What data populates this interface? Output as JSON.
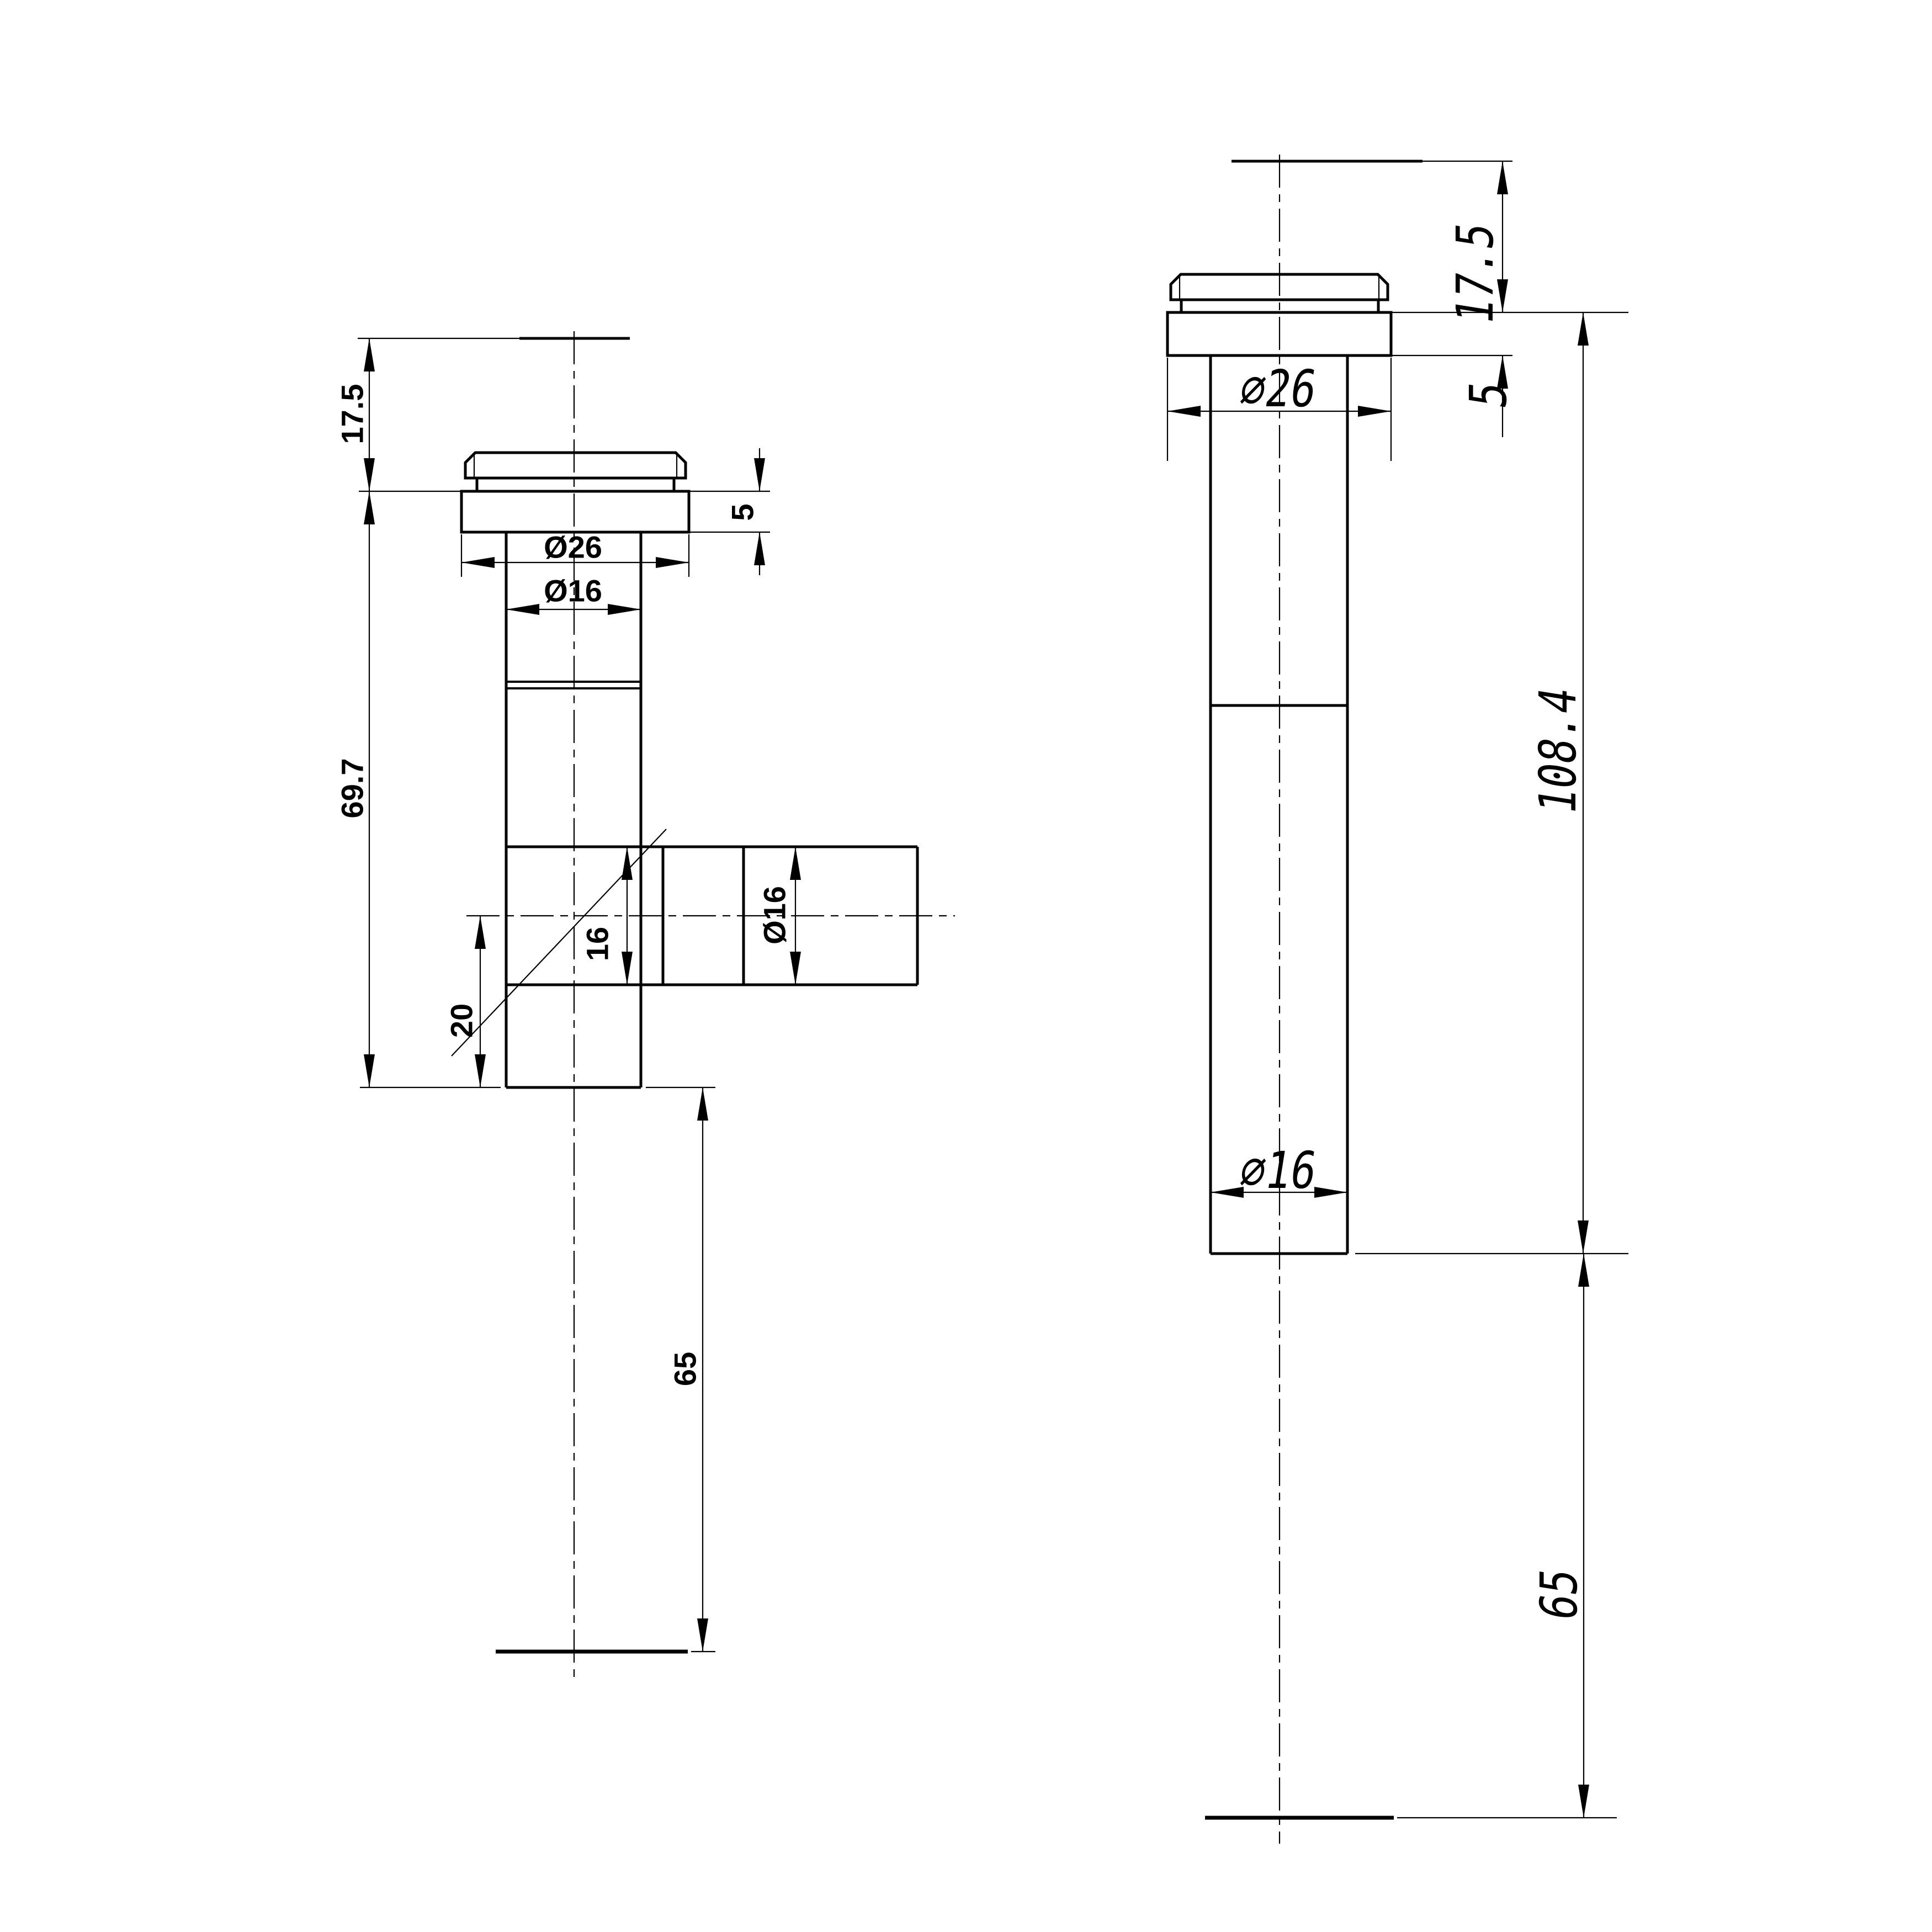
{
  "drawing": {
    "type": "engineering-2d-orthographic",
    "background_color": "#ffffff",
    "line_color": "#000000",
    "views": {
      "left": {
        "name": "side view with outlet arm",
        "dims": {
          "height_top": "17.5",
          "flange_thickness": "5",
          "flange_diameter": "Ø26",
          "tube_diameter": "Ø16",
          "body_length": "69.7",
          "arm_bore": "16",
          "arm_diameter": "Ø16",
          "offset_bottom": "20",
          "tail_length": "65"
        }
      },
      "right": {
        "name": "straight view",
        "dims": {
          "height_top": "17.5",
          "flange_diameter": "∅26",
          "flange_thickness": "5",
          "body_length": "108.4",
          "tube_diameter": "∅16",
          "tail_length": "65"
        }
      }
    }
  }
}
